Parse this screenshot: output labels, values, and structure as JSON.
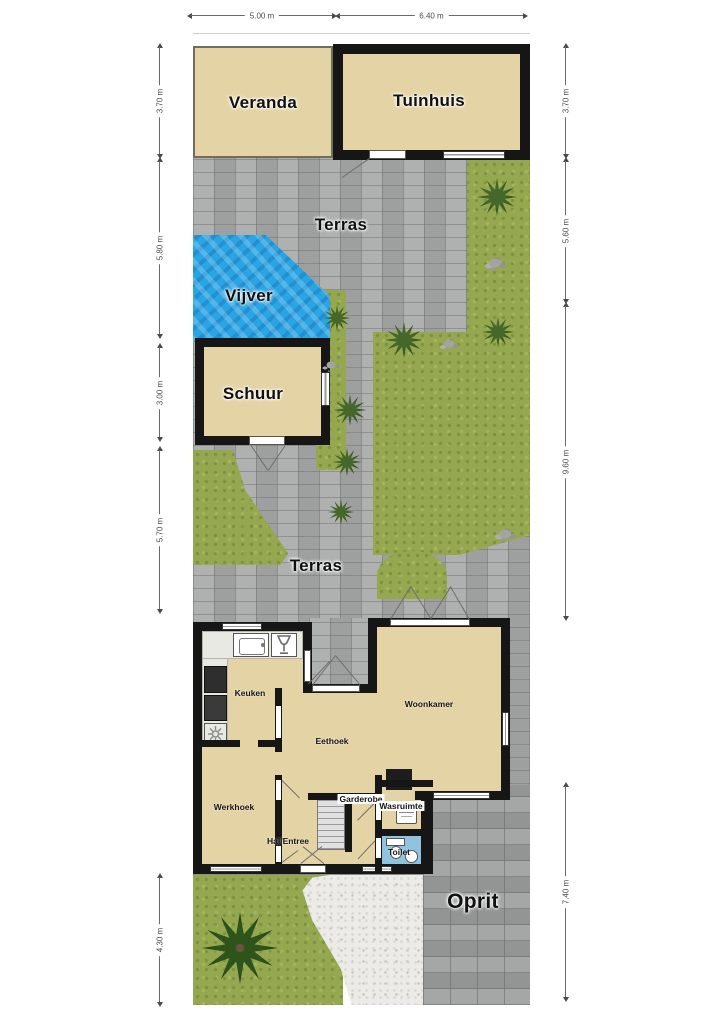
{
  "plan": {
    "areas": {
      "veranda": "Veranda",
      "tuinhuis": "Tuinhuis",
      "terras_top": "Terras",
      "vijver": "Vijver",
      "schuur": "Schuur",
      "terras_mid": "Terras",
      "oprit": "Oprit"
    },
    "rooms": {
      "keuken": "Keuken",
      "woonkamer": "Woonkamer",
      "eethoek": "Eethoek",
      "werkhoek": "Werkhoek",
      "garderobe": "Garderobe",
      "wasruimte": "Wasruimte",
      "hal": "Hal/Entree",
      "toilet": "Toilet"
    },
    "dimensions": {
      "top": [
        "5.00 m",
        "6.40 m"
      ],
      "left": [
        "3.70 m",
        "5.80 m",
        "3.00 m",
        "5.70 m",
        "4.30 m"
      ],
      "right": [
        "3.70 m",
        "5.60 m",
        "9.60 m",
        "7.40 m"
      ]
    },
    "colors": {
      "room_fill": "#e4d3a4",
      "wall": "#161616",
      "water": "#2aa5e4",
      "grass": "#95a850",
      "paving": "#a8aaa9",
      "driveway_paving": "#9da09e",
      "toilet_floor": "#8fc3de"
    },
    "icons": [
      "sink-icon",
      "glass-icon",
      "cooktop-icon",
      "oven-icon",
      "fridge-icon",
      "laundry-basket-icon",
      "toilet-icon",
      "washbasin-icon",
      "fireplace-icon"
    ]
  }
}
